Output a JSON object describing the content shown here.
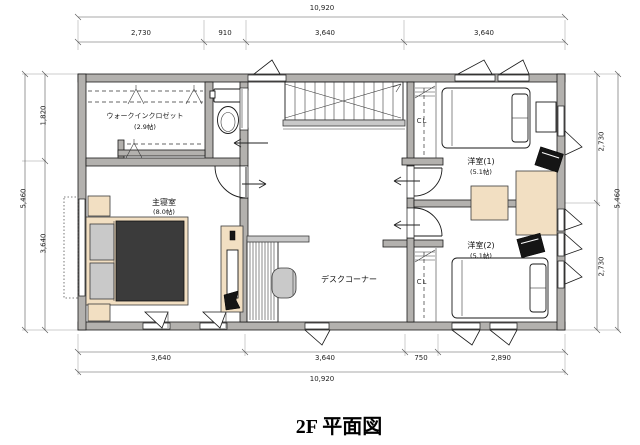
{
  "title": "2F 平面図",
  "rooms": {
    "wic": {
      "name": "ウォークインクロゼット",
      "size": "(2.9帖)"
    },
    "master": {
      "name": "主寝室",
      "size": "(8.0帖)"
    },
    "room1": {
      "name": "洋室(1)",
      "size": "(5.1帖)"
    },
    "room2": {
      "name": "洋室(2)",
      "size": "(5.1帖)"
    },
    "desk_corner": {
      "name": "デスクコーナー"
    },
    "closet1": {
      "label": "CL"
    },
    "closet2": {
      "label": "CL"
    }
  },
  "dimensions": {
    "top": {
      "total": "10,920",
      "segments": [
        "2,730",
        "910",
        "3,640",
        "3,640"
      ]
    },
    "bottom": {
      "total": "10,920",
      "segments": [
        "3,640",
        "3,640",
        "750",
        "2,890"
      ]
    },
    "left": {
      "total": "5,460",
      "segments": [
        "1,820",
        "3,640"
      ]
    },
    "right": {
      "total": "5,460",
      "segments": [
        "2,730",
        "2,730"
      ]
    }
  },
  "colors": {
    "wall": "#b3b1ae",
    "furniture": "#f2dfc2",
    "duvet": "#3b3b3b",
    "background": "#ffffff"
  }
}
